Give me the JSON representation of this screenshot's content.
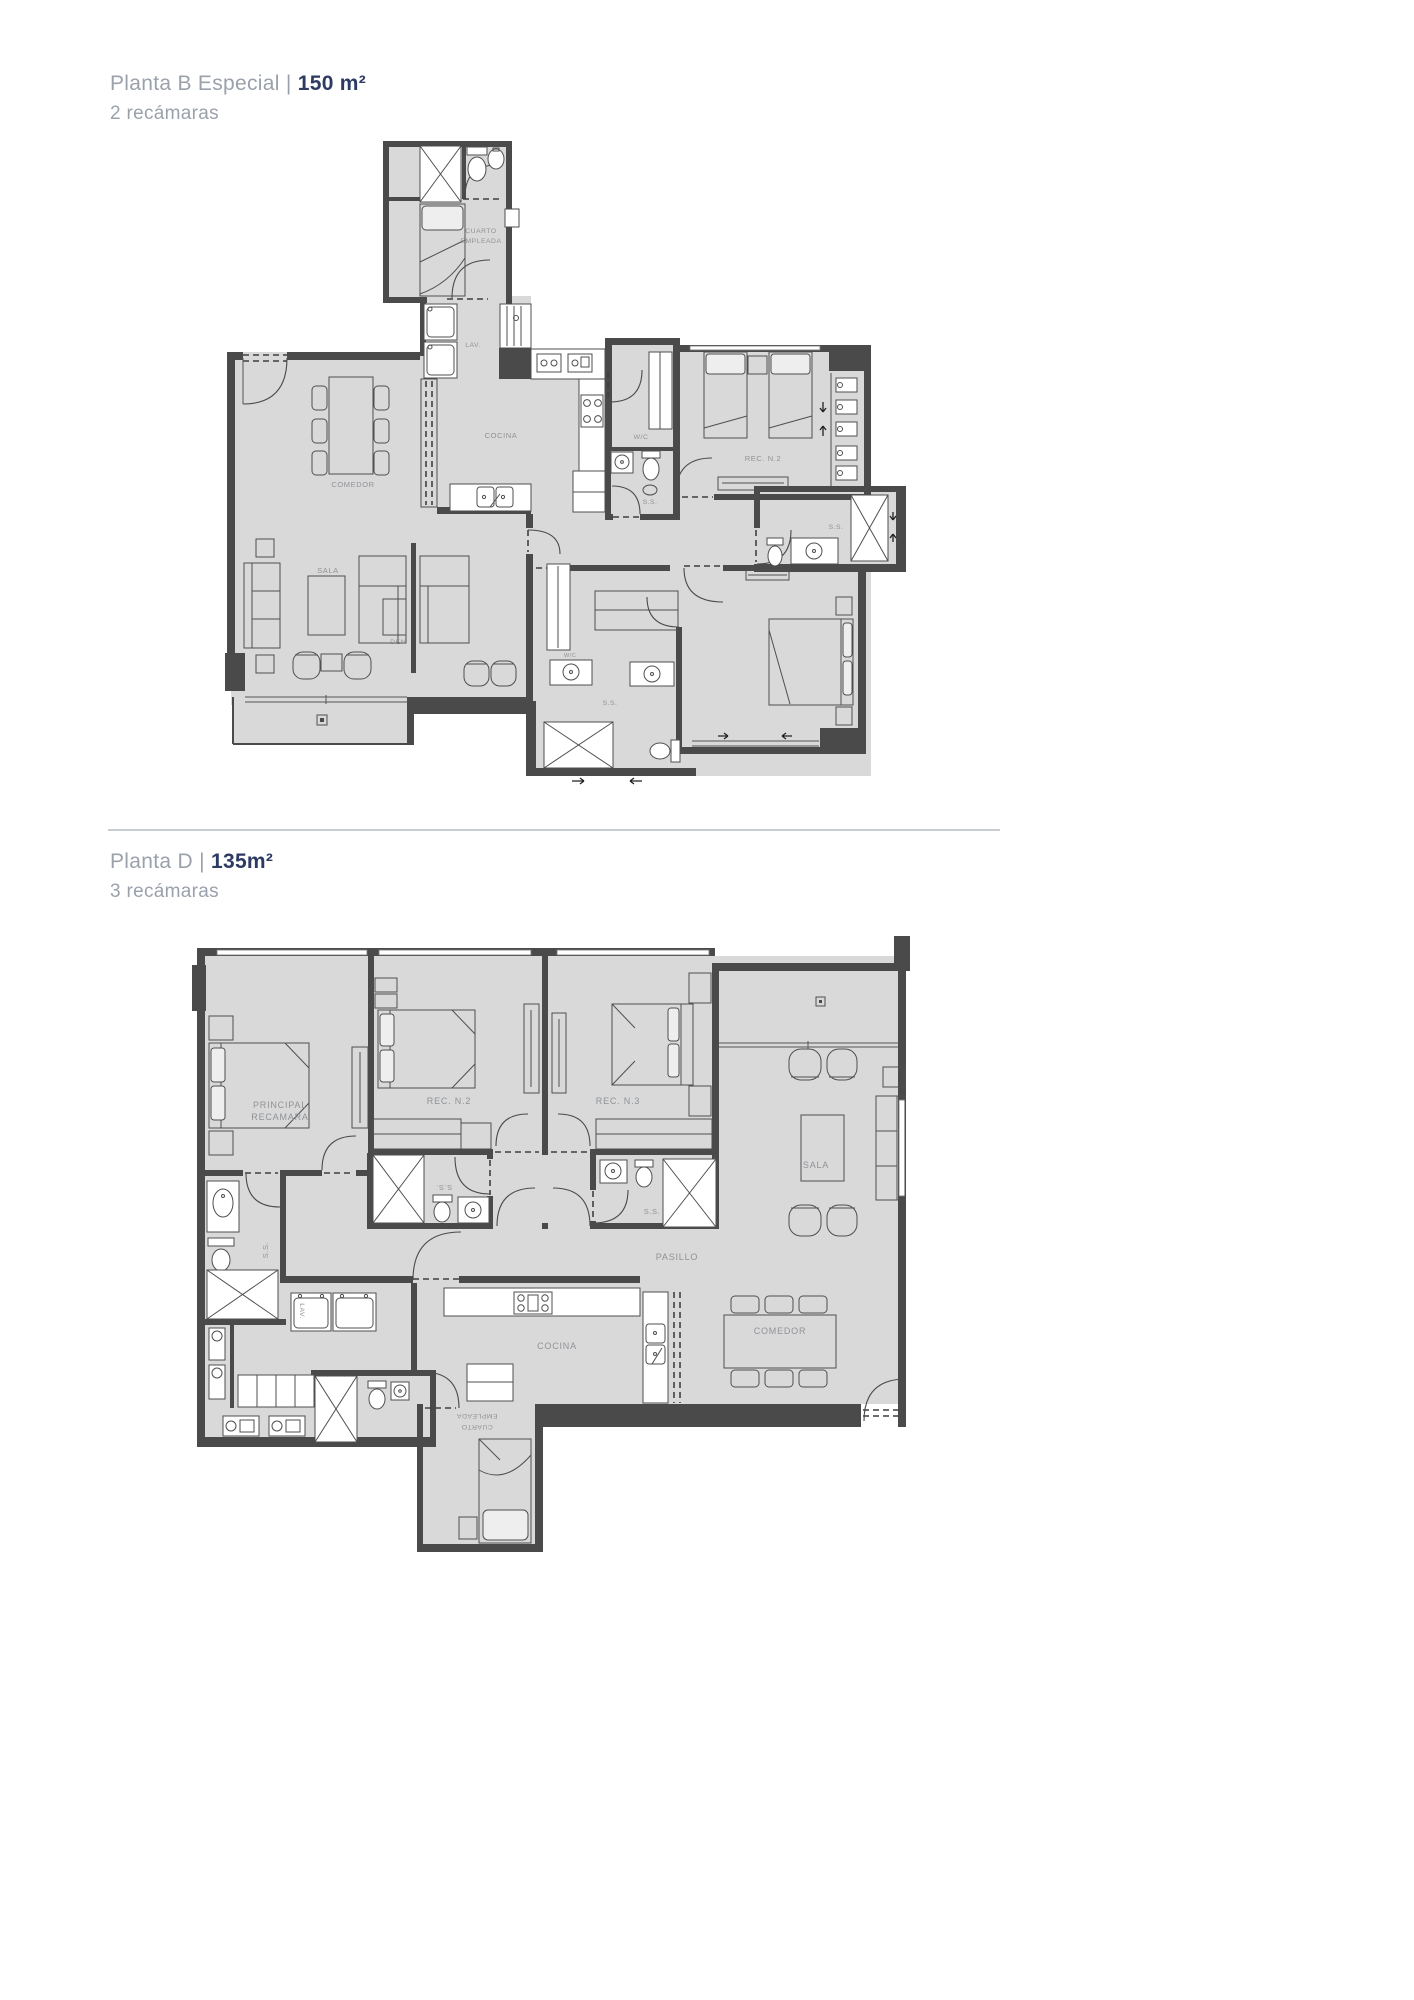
{
  "header1": {
    "title": "Planta B Especial",
    "pipe": "| ",
    "area": "150 m²",
    "subtitle": "2 recámaras"
  },
  "header2": {
    "title": "Planta D",
    "pipe": "| ",
    "area": "135m²",
    "subtitle": "3 recámaras"
  },
  "plan1": {
    "labels": {
      "cuarto1": "CUARTO",
      "cuarto2": "EMPLEADA",
      "lav": "LAV.",
      "cocina": "COCINA",
      "comedor": "COMEDOR",
      "wc": "W/C",
      "ss": "S.S.",
      "rec_n2": "REC. N.2",
      "sala": "SALA",
      "den": "DEN"
    }
  },
  "plan2": {
    "labels": {
      "principal1": "PRINCIPAL",
      "principal2": "RECAMARA",
      "rec_n2": "REC. N.2",
      "rec_n3": "REC. N.3",
      "sala": "SALA",
      "ss": "S.S.",
      "pasillo": "PASILLO",
      "cocina": "COCINA",
      "comedor": "COMEDOR",
      "cuarto1": "CUARTO",
      "cuarto2": "EMPLEADA",
      "lav": "LAV."
    }
  },
  "colors": {
    "wall": "#4a4a4a",
    "floor": "#d9d9d9",
    "label": "#8f9296",
    "title_gray": "#9ba1ab",
    "title_accent": "#2d3a62",
    "divider": "#c7ccd2"
  }
}
